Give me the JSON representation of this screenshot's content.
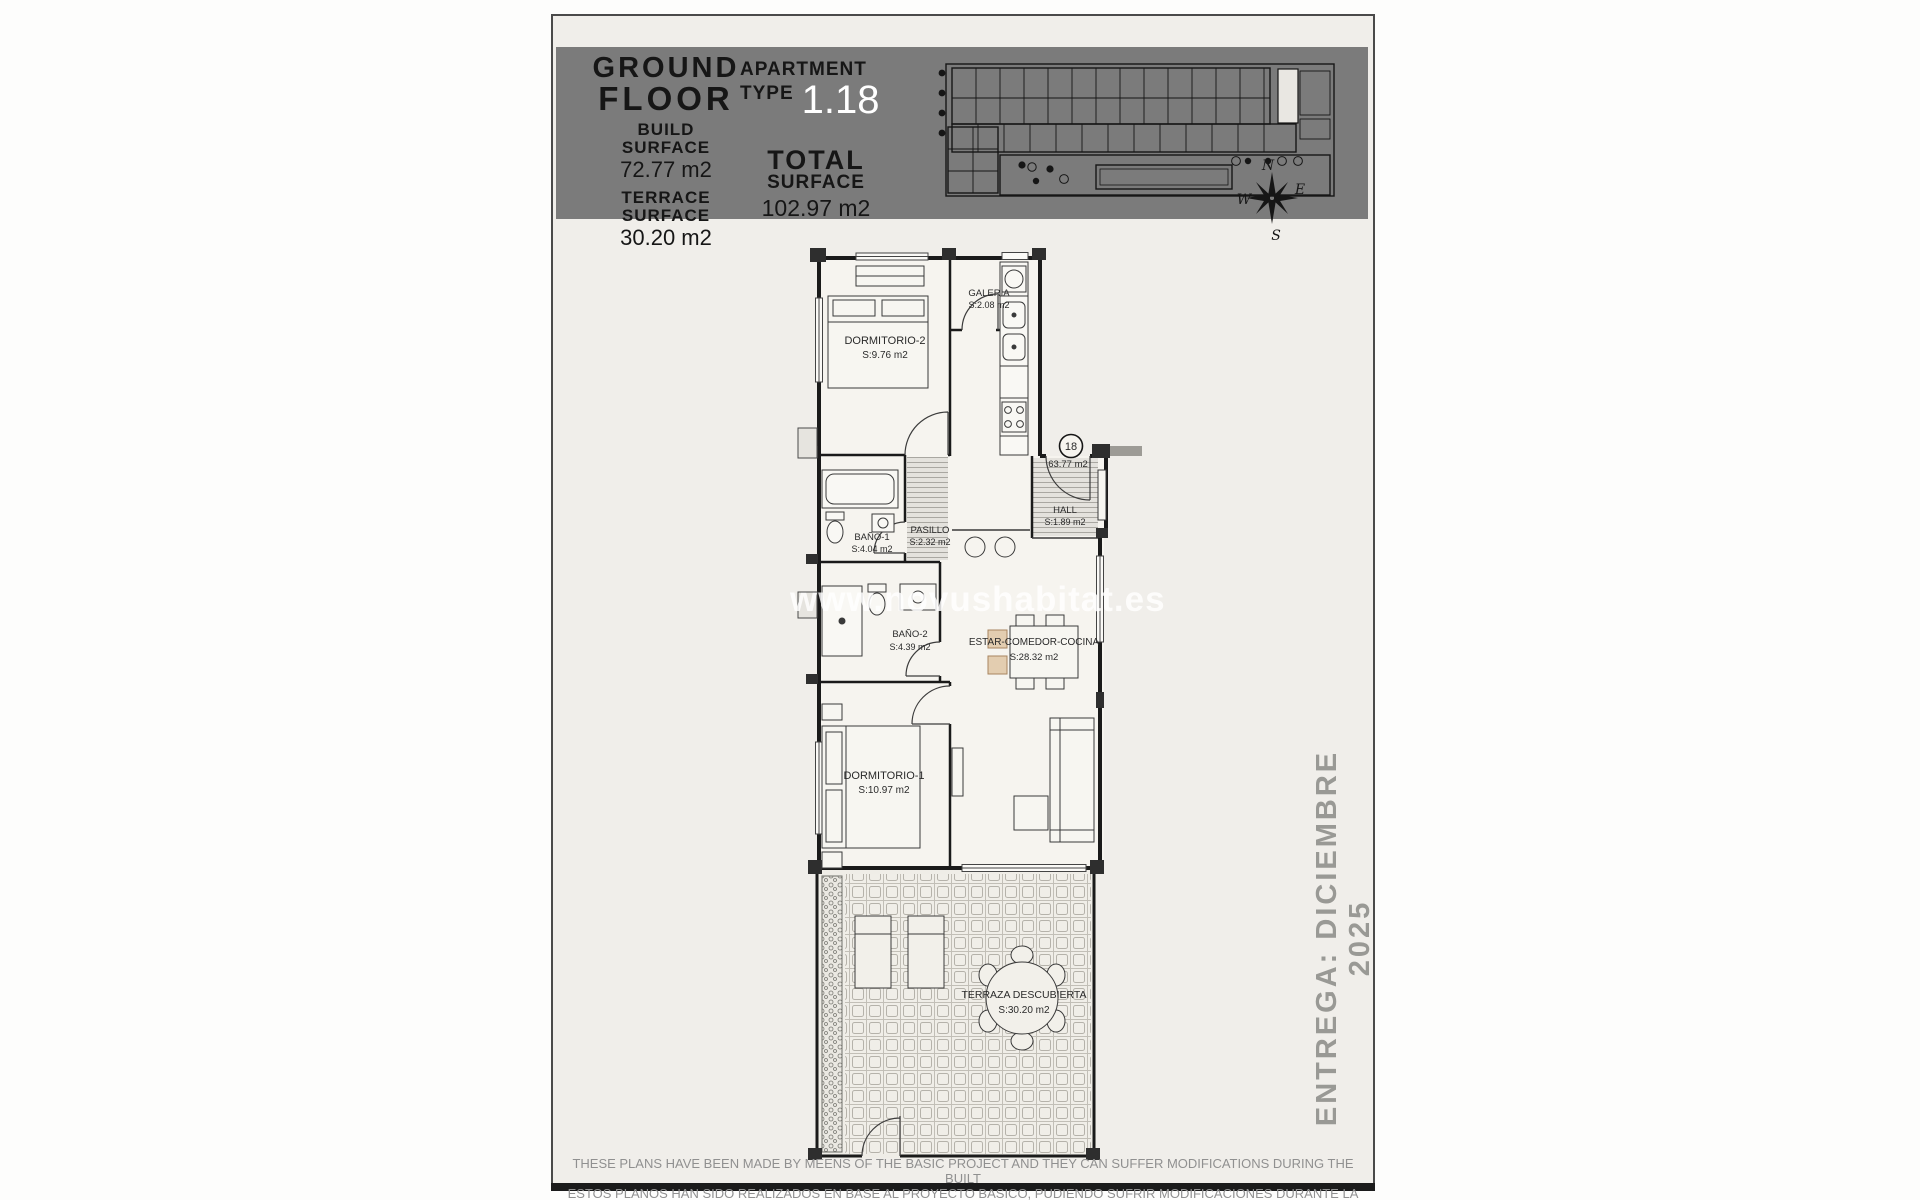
{
  "colors": {
    "page_bg": "#f0eeea",
    "header_bg": "#7b7b7b",
    "header_text": "#161616",
    "apartment_number_text": "#ffffff",
    "plan_line": "#1a1a1a",
    "muted_text": "#999995"
  },
  "header": {
    "floor_word1": "GROUND",
    "floor_word2": "FLOOR",
    "build_label1": "BUILD",
    "build_label2": "SURFACE",
    "build_value": "72.77 m2",
    "terrace_label1": "TERRACE",
    "terrace_label2": "SURFACE",
    "terrace_value": "30.20 m2",
    "apt_label1": "APARTMENT",
    "apt_label2": "TYPE",
    "apt_value": "1.18",
    "total_label1": "TOTAL",
    "total_label2": "SURFACE",
    "total_value": "102.97 m2"
  },
  "compass": {
    "north": "N",
    "east": "E",
    "south": "S",
    "west": "W"
  },
  "floor_plan": {
    "unit_badge": "18",
    "unit_area": "63.77 m2",
    "rooms": [
      {
        "name": "DORMITORIO-2",
        "area": "S:9.76 m2"
      },
      {
        "name": "GALERIA",
        "area": "S:2.08 m2"
      },
      {
        "name": "BAÑO-1",
        "area": "S:4.04 m2"
      },
      {
        "name": "PASILLO",
        "area": "S:2.32 m2"
      },
      {
        "name": "HALL",
        "area": "S:1.89 m2"
      },
      {
        "name": "BAÑO-2",
        "area": "S:4.39 m2"
      },
      {
        "name": "ESTAR-COMEDOR-COCINA",
        "area": "S:28.32 m2"
      },
      {
        "name": "DORMITORIO-1",
        "area": "S:10.97 m2"
      },
      {
        "name": "TERRAZA DESCUBIERTA",
        "area": "S:30.20 m2"
      }
    ]
  },
  "watermark": "www.novushabitat.es",
  "delivery": "ENTREGA: DICIEMBRE 2025",
  "disclaimer": {
    "line1": "THESE PLANS HAVE BEEN MADE BY MEENS OF THE BASIC PROJECT AND THEY CAN SUFFER MODIFICATIONS DURING THE BUILT",
    "line2": "ESTOS PLANOS HAN SIDO REALIZADOS EN BASE AL PROYECTO BASICO, PUDIENDO SUFRIR MODIFICACIONES DURANTE LA EJECUCION"
  }
}
